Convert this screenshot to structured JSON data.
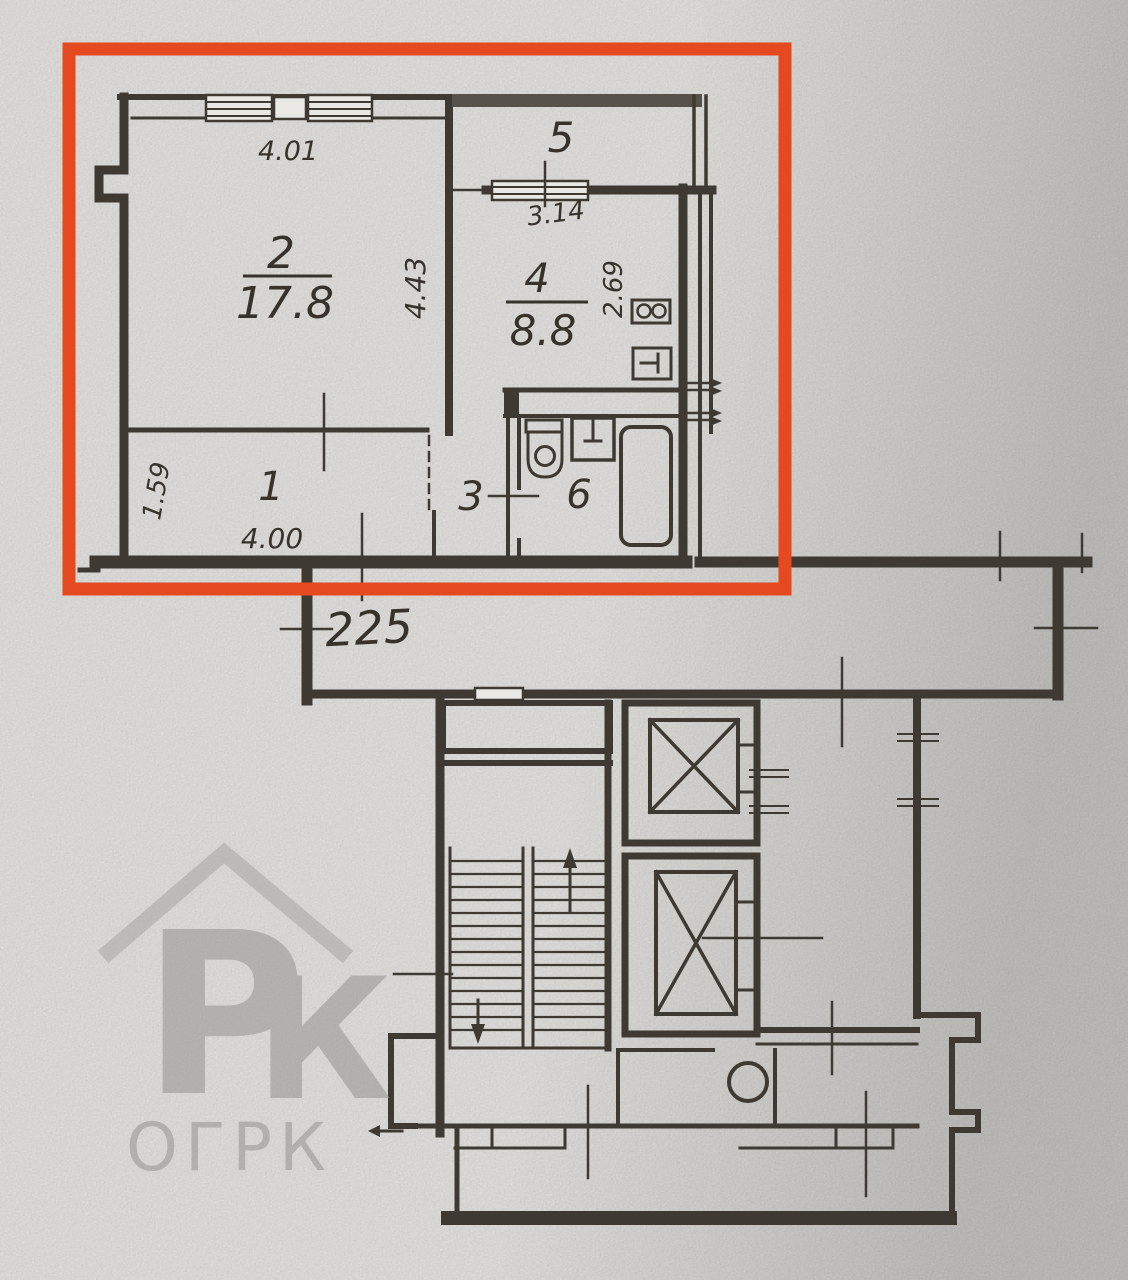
{
  "document": {
    "type": "apartment-floorplan-scan",
    "highlighted_unit": true
  },
  "colors": {
    "highlight": "#e5491f",
    "ink": "#3a362f",
    "paper": "#e9e8e5",
    "watermark": "#8f8d8b"
  },
  "apartment": {
    "rooms": [
      {
        "key": "room-2-living",
        "number": "2",
        "area": "17.8"
      },
      {
        "key": "room-4-kitchen",
        "number": "4",
        "area": "8.8"
      },
      {
        "key": "room-5-balcony",
        "number": "5",
        "area": ""
      },
      {
        "key": "room-1-hall",
        "number": "1",
        "area": ""
      },
      {
        "key": "room-3-lobby",
        "number": "3",
        "area": ""
      },
      {
        "key": "room-6-bath",
        "number": "6",
        "area": ""
      }
    ],
    "dimensions": [
      {
        "key": "dim-room2-width",
        "value": "4.01"
      },
      {
        "key": "dim-room2-depth",
        "value": "4.43"
      },
      {
        "key": "dim-kitchen-window",
        "value": "3.14"
      },
      {
        "key": "dim-kitchen-depth",
        "value": "2.69"
      },
      {
        "key": "dim-hall-depth",
        "value": "1.59"
      },
      {
        "key": "dim-hall-width",
        "value": "4.00"
      },
      {
        "key": "dim-corridor",
        "value": "225"
      }
    ]
  },
  "watermark": {
    "monogram_p": "Р",
    "monogram_k": "К",
    "brand": "ОГРК"
  }
}
